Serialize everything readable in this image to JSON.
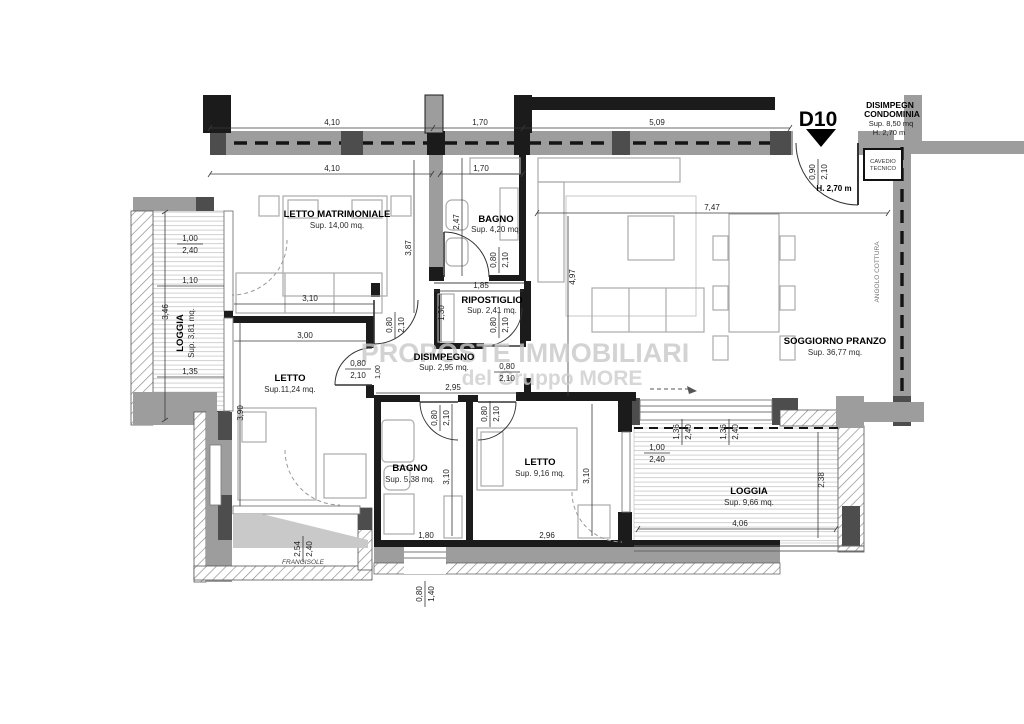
{
  "unit": {
    "code": "D10",
    "condominium": [
      "DISIMPEGN",
      "CONDOMINIA",
      "Sup. 8,50 mq",
      "H. 2,70 m"
    ],
    "entry_height": "H. 2,70 m"
  },
  "watermark": {
    "line1": "PROPOSTE IMMOBILIARI",
    "line2": "del Gruppo MORE"
  },
  "rooms": [
    {
      "name": "LETTO MATRIMONIALE",
      "area": "Sup. 14,00 mq."
    },
    {
      "name": "BAGNO",
      "area": "Sup. 4,20 mq."
    },
    {
      "name": "RIPOSTIGLIO",
      "area": "Sup. 2,41 mq."
    },
    {
      "name": "DISIMPEGNO",
      "area": "Sup. 2,95 mq."
    },
    {
      "name": "SOGGIORNO PRANZO",
      "area": "Sup. 36,77 mq."
    },
    {
      "name": "LETTO",
      "area": "Sup.11,24 mq."
    },
    {
      "name": "BAGNO",
      "area": "Sup. 5,38 mq."
    },
    {
      "name": "LETTO",
      "area": "Sup. 9,16 mq."
    },
    {
      "name": "LOGGIA",
      "area": "Sup. 3,81 mq."
    },
    {
      "name": "LOGGIA",
      "area": "Sup. 9,66 mq."
    }
  ],
  "labels": {
    "cavedio1": "CAVEDIO",
    "cavedio2": "TECNICO",
    "angolo_cottura": "ANGOLO COTTURA",
    "frangisole": "FRANGISOLE"
  },
  "dims": [
    "4,10",
    "1,70",
    "5,09",
    "4,10",
    "1,70",
    "7,47",
    "4,97",
    "3,87",
    "2,47",
    "0,80",
    "2,10",
    "1,85",
    "1,30",
    "0,80",
    "2,10",
    "0,80",
    "2,10",
    "0,80",
    "2,10",
    "2,95",
    "1,00",
    "2,40",
    "1,10",
    "3,46",
    "1,35",
    "0,80",
    "2,10",
    "1,00",
    "3,90",
    "0,80",
    "2,10",
    "0,80",
    "2,10",
    "3,10",
    "3,10",
    "1,80",
    "2,96",
    "2,54",
    "2,40",
    "0,80",
    "1,40",
    "1,36",
    "2,40",
    "1,36",
    "2,40",
    "1,00",
    "2,40",
    "2,38",
    "4,06",
    "0,90",
    "2,10",
    "3,10",
    "3,00"
  ]
}
